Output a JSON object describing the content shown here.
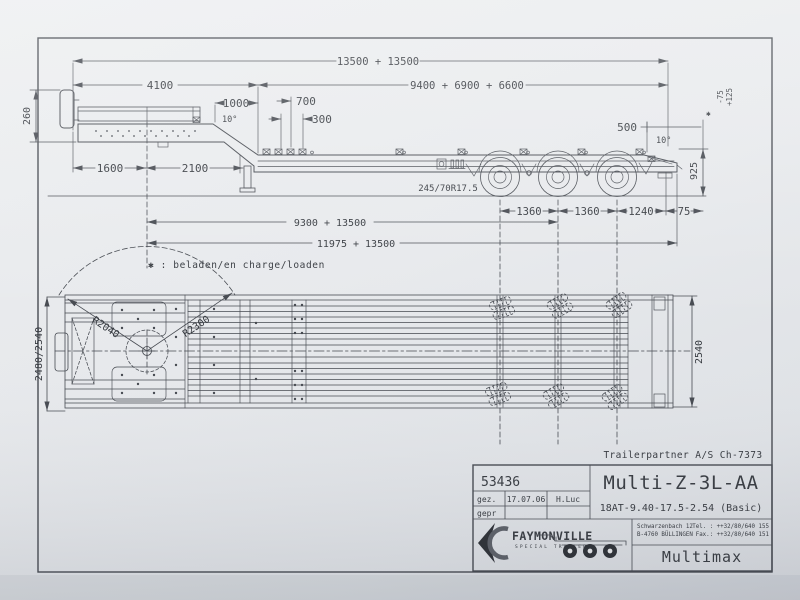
{
  "colors": {
    "paper": "#e8eaec",
    "ink": "#44484f"
  },
  "sv": {
    "d13500": "13500 + 13500",
    "d4100": "4100",
    "d9400": "9400 + 6900 + 6600",
    "d1000": "1000",
    "d700": "700",
    "d300": "300",
    "d260": "260",
    "a10f": "10°",
    "d1600": "1600",
    "d2100": "2100",
    "tire": "245/70R17.5",
    "d1360a": "1360",
    "d1360b": "1360",
    "d1240": "1240",
    "d75": "75",
    "d9300": "9300 + 13500",
    "d11975": "11975 + 13500",
    "d500": "500",
    "a10r": "10°",
    "d925": "925",
    "mark": "✱",
    "tolm": "-75",
    "tolp": "+125"
  },
  "note": "✱ : beladen/en charge/loaden",
  "pv": {
    "w_front": "2480/2540",
    "w_rear": "2540",
    "r_inner": "R2040",
    "r_outer": "R2300"
  },
  "tb": {
    "customer": "Trailerpartner A/S Ch-7373",
    "number": "53436",
    "gez": "gez.",
    "date": "17.07.06",
    "author": "H.Luc",
    "gepr": "gepr",
    "model": "Multi-Z-3L-AA",
    "spec": "18AT-9.40-17.5-2.54 (Basic)",
    "brand": "FAYMONVILLE",
    "brand_sub": "SPECIAL TRAILERS",
    "addr1": "Schwarzenbach 12",
    "addr2": "B-4760 BÜLLINGEN",
    "tel": "Tel. : ++32/80/640 155",
    "fax": "Fax.: ++32/80/640 151",
    "product": "Multimax"
  }
}
